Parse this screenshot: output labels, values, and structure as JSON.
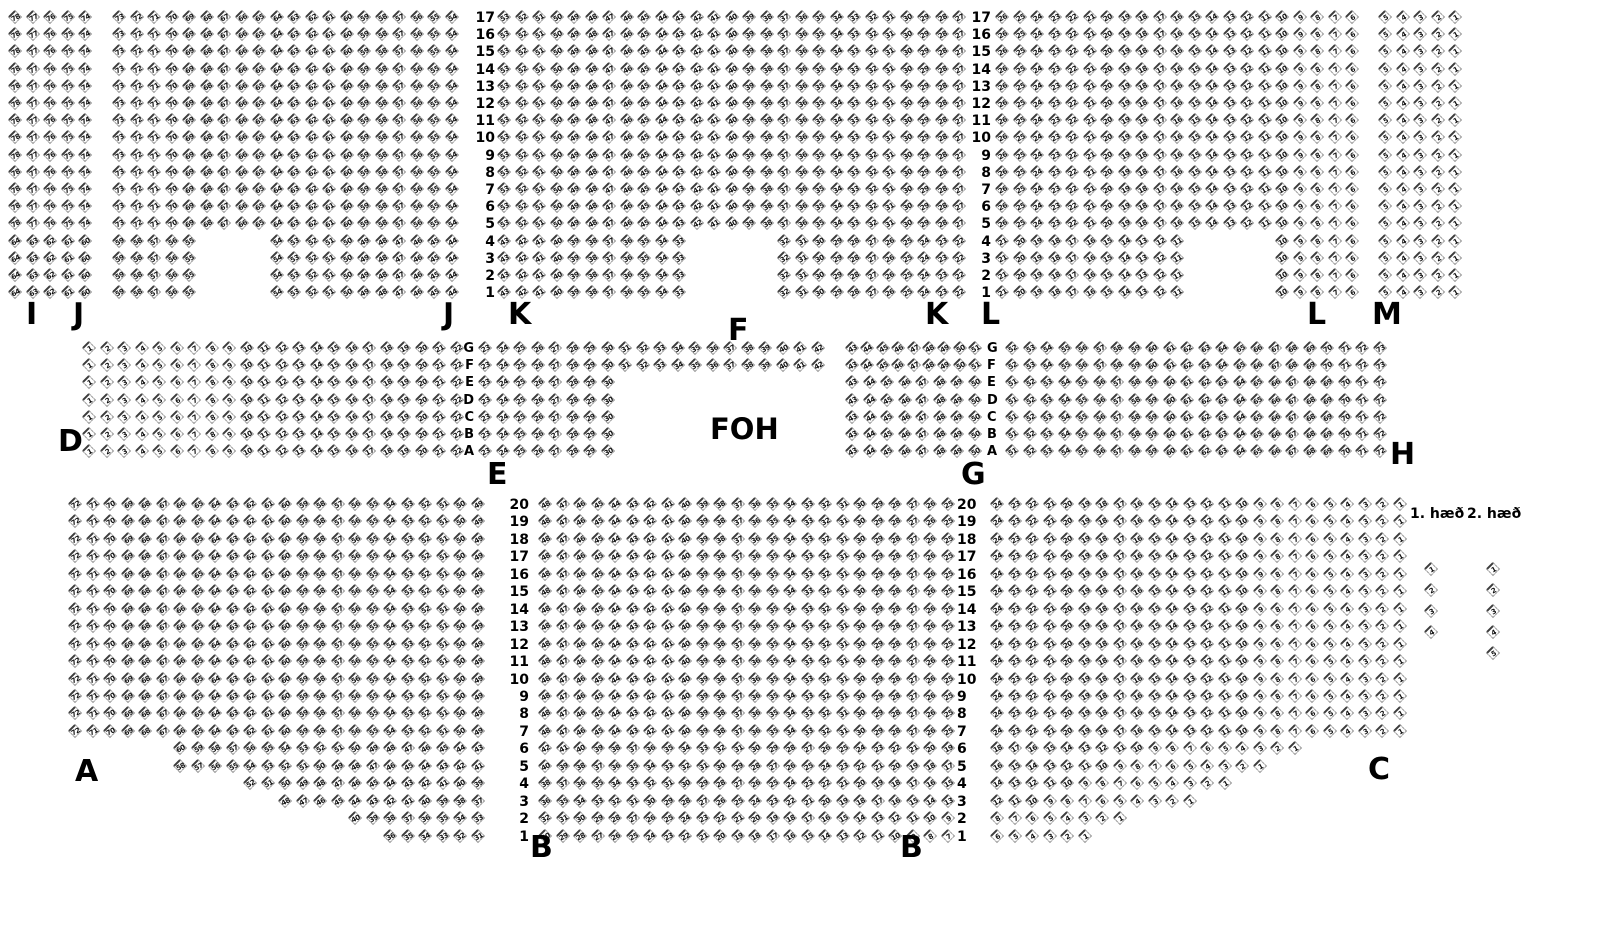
{
  "labels": {
    "foh": "FOH",
    "floor1": "1. hæð",
    "floor2": "2. hæð"
  },
  "colors": {
    "background": "#ffffff",
    "seat_outline": "#9b9b9b",
    "seat_accent": "#3c3c3c",
    "text": "#000000"
  },
  "seat_map": {
    "pitch_x": 17.5,
    "section_labels": [
      {
        "text": "I",
        "x": 26,
        "y": 300
      },
      {
        "text": "J",
        "x": 73,
        "y": 300
      },
      {
        "text": "J",
        "x": 443,
        "y": 300
      },
      {
        "text": "K",
        "x": 508,
        "y": 300
      },
      {
        "text": "F",
        "x": 728,
        "y": 316
      },
      {
        "text": "K",
        "x": 925,
        "y": 300
      },
      {
        "text": "L",
        "x": 981,
        "y": 300
      },
      {
        "text": "L",
        "x": 1307,
        "y": 300
      },
      {
        "text": "M",
        "x": 1372,
        "y": 300
      },
      {
        "text": "D",
        "x": 58,
        "y": 427
      },
      {
        "text": "E",
        "x": 487,
        "y": 460
      },
      {
        "text": "G",
        "x": 961,
        "y": 460
      },
      {
        "text": "H",
        "x": 1390,
        "y": 440
      },
      {
        "text": "A",
        "x": 75,
        "y": 757
      },
      {
        "text": "B",
        "x": 530,
        "y": 833
      },
      {
        "text": "B",
        "x": 900,
        "y": 833
      },
      {
        "text": "C",
        "x": 1368,
        "y": 755
      }
    ],
    "bands": [
      {
        "id": "balcony-upper",
        "y": 10,
        "pitch_y": 17.2,
        "rows": 17,
        "row_label_start": 17,
        "direction": "rtl",
        "number_cols": [
          {
            "x": 495,
            "align": "right"
          },
          {
            "x": 991,
            "align": "right"
          }
        ],
        "row_groups": [
          {
            "rows": [
              0,
              12
            ],
            "segments": [
              {
                "sec": "I",
                "x": 8,
                "n": 5,
                "start": 78
              },
              {
                "sec": "J",
                "x": 112,
                "n": 20,
                "start": 73
              },
              {
                "sec": "K",
                "x": 497,
                "n": 27,
                "start": 53
              },
              {
                "sec": "L",
                "x": 995,
                "n": 21,
                "start": 26
              },
              {
                "sec": "M",
                "x": 1378,
                "n": 5,
                "start": 5
              }
            ]
          },
          {
            "rows": [
              13,
              16
            ],
            "segments": [
              {
                "sec": "I",
                "x": 8,
                "n": 5,
                "start": 64
              },
              {
                "sec": "J",
                "x": 112,
                "n": 5,
                "start": 59
              },
              {
                "sec": "J",
                "x": 269.5,
                "n": 11,
                "start": 54
              },
              {
                "sec": "K",
                "x": 497,
                "n": 11,
                "start": 43
              },
              {
                "sec": "K",
                "x": 777,
                "n": 11,
                "start": 32
              },
              {
                "sec": "L",
                "x": 995,
                "n": 11,
                "start": 21
              },
              {
                "sec": "L",
                "x": 1275,
                "n": 5,
                "start": 10
              },
              {
                "sec": "M",
                "x": 1378,
                "n": 5,
                "start": 5
              }
            ]
          }
        ]
      },
      {
        "id": "balcony-front",
        "y": 341,
        "pitch_y": 17.2,
        "rows": 7,
        "row_labels": [
          "G",
          "F",
          "E",
          "D",
          "C",
          "B",
          "A"
        ],
        "label_font": 13,
        "direction": "ltr",
        "number_cols": [
          {
            "x": 474,
            "align": "right"
          },
          {
            "x": 987,
            "align": "left"
          }
        ],
        "row_groups": [
          {
            "rows": [
              0,
              1
            ],
            "segments": [
              {
                "sec": "D",
                "x": 82,
                "n": 22,
                "start": 1
              },
              {
                "sec": "E",
                "x": 478,
                "n": 8,
                "start": 23
              },
              {
                "sec": "F",
                "x": 618,
                "n": 12,
                "start": 31
              },
              {
                "sec": "G",
                "x": 845,
                "n": 9,
                "start": 43,
                "pitch": 15.4
              },
              {
                "sec": "H",
                "x": 1005,
                "n": 22,
                "start": 52
              }
            ]
          },
          {
            "rows": [
              2,
              6
            ],
            "segments": [
              {
                "sec": "D",
                "x": 82,
                "n": 22,
                "start": 1
              },
              {
                "sec": "E",
                "x": 478,
                "n": 8,
                "start": 23
              },
              {
                "sec": "G",
                "x": 845,
                "n": 8,
                "start": 43
              },
              {
                "sec": "H",
                "x": 1005,
                "n": 22,
                "start": 51
              }
            ]
          }
        ]
      },
      {
        "id": "main-floor",
        "y": 497,
        "pitch_y": 17.45,
        "rows": 20,
        "row_label_start": 20,
        "direction": "rtl",
        "number_cols": [
          {
            "x": 529,
            "align": "right"
          },
          {
            "x": 957,
            "align": "left"
          }
        ],
        "row_groups": [
          {
            "rows": [
              0,
              13
            ],
            "segments": [
              {
                "sec": "A",
                "x": 68,
                "n": 24,
                "start": 72
              },
              {
                "sec": "B",
                "x": 538,
                "n": 24,
                "start": 48
              },
              {
                "sec": "C",
                "x": 990,
                "n": 24,
                "start": 24
              }
            ]
          },
          {
            "rows": [
              14,
              14
            ],
            "segments": [
              {
                "sec": "A",
                "x": 173,
                "n": 18,
                "start": 60
              },
              {
                "sec": "B",
                "x": 538,
                "n": 24,
                "start": 42
              },
              {
                "sec": "C",
                "x": 990,
                "n": 18,
                "start": 18
              }
            ]
          },
          {
            "rows": [
              15,
              15
            ],
            "segments": [
              {
                "sec": "A",
                "x": 173,
                "n": 18,
                "start": 58
              },
              {
                "sec": "B",
                "x": 538,
                "n": 24,
                "start": 40
              },
              {
                "sec": "C",
                "x": 990,
                "n": 16,
                "start": 16
              }
            ]
          },
          {
            "rows": [
              16,
              16
            ],
            "segments": [
              {
                "sec": "A",
                "x": 243,
                "n": 14,
                "start": 52
              },
              {
                "sec": "B",
                "x": 538,
                "n": 24,
                "start": 38
              },
              {
                "sec": "C",
                "x": 990,
                "n": 14,
                "start": 14
              }
            ]
          },
          {
            "rows": [
              17,
              17
            ],
            "segments": [
              {
                "sec": "A",
                "x": 278,
                "n": 12,
                "start": 48
              },
              {
                "sec": "B",
                "x": 538,
                "n": 24,
                "start": 36
              },
              {
                "sec": "C",
                "x": 990,
                "n": 12,
                "start": 12
              }
            ]
          },
          {
            "rows": [
              18,
              18
            ],
            "segments": [
              {
                "sec": "A",
                "x": 348,
                "n": 8,
                "start": 40
              },
              {
                "sec": "B",
                "x": 538,
                "n": 24,
                "start": 32
              },
              {
                "sec": "C",
                "x": 990,
                "n": 8,
                "start": 8
              }
            ]
          },
          {
            "rows": [
              19,
              19
            ],
            "segments": [
              {
                "sec": "A",
                "x": 383,
                "n": 6,
                "start": 36
              },
              {
                "sec": "B",
                "x": 538,
                "n": 24,
                "start": 30
              },
              {
                "sec": "C",
                "x": 990,
                "n": 6,
                "start": 6
              }
            ]
          }
        ]
      }
    ],
    "strips": [
      {
        "sec": "floor1",
        "x": 1424,
        "y": 562,
        "pitch": 21,
        "seats": [
          1,
          2,
          3,
          4
        ]
      },
      {
        "sec": "floor2",
        "x": 1486,
        "y": 562,
        "pitch": 21,
        "seats": [
          1,
          2,
          3,
          4,
          5
        ]
      }
    ]
  }
}
